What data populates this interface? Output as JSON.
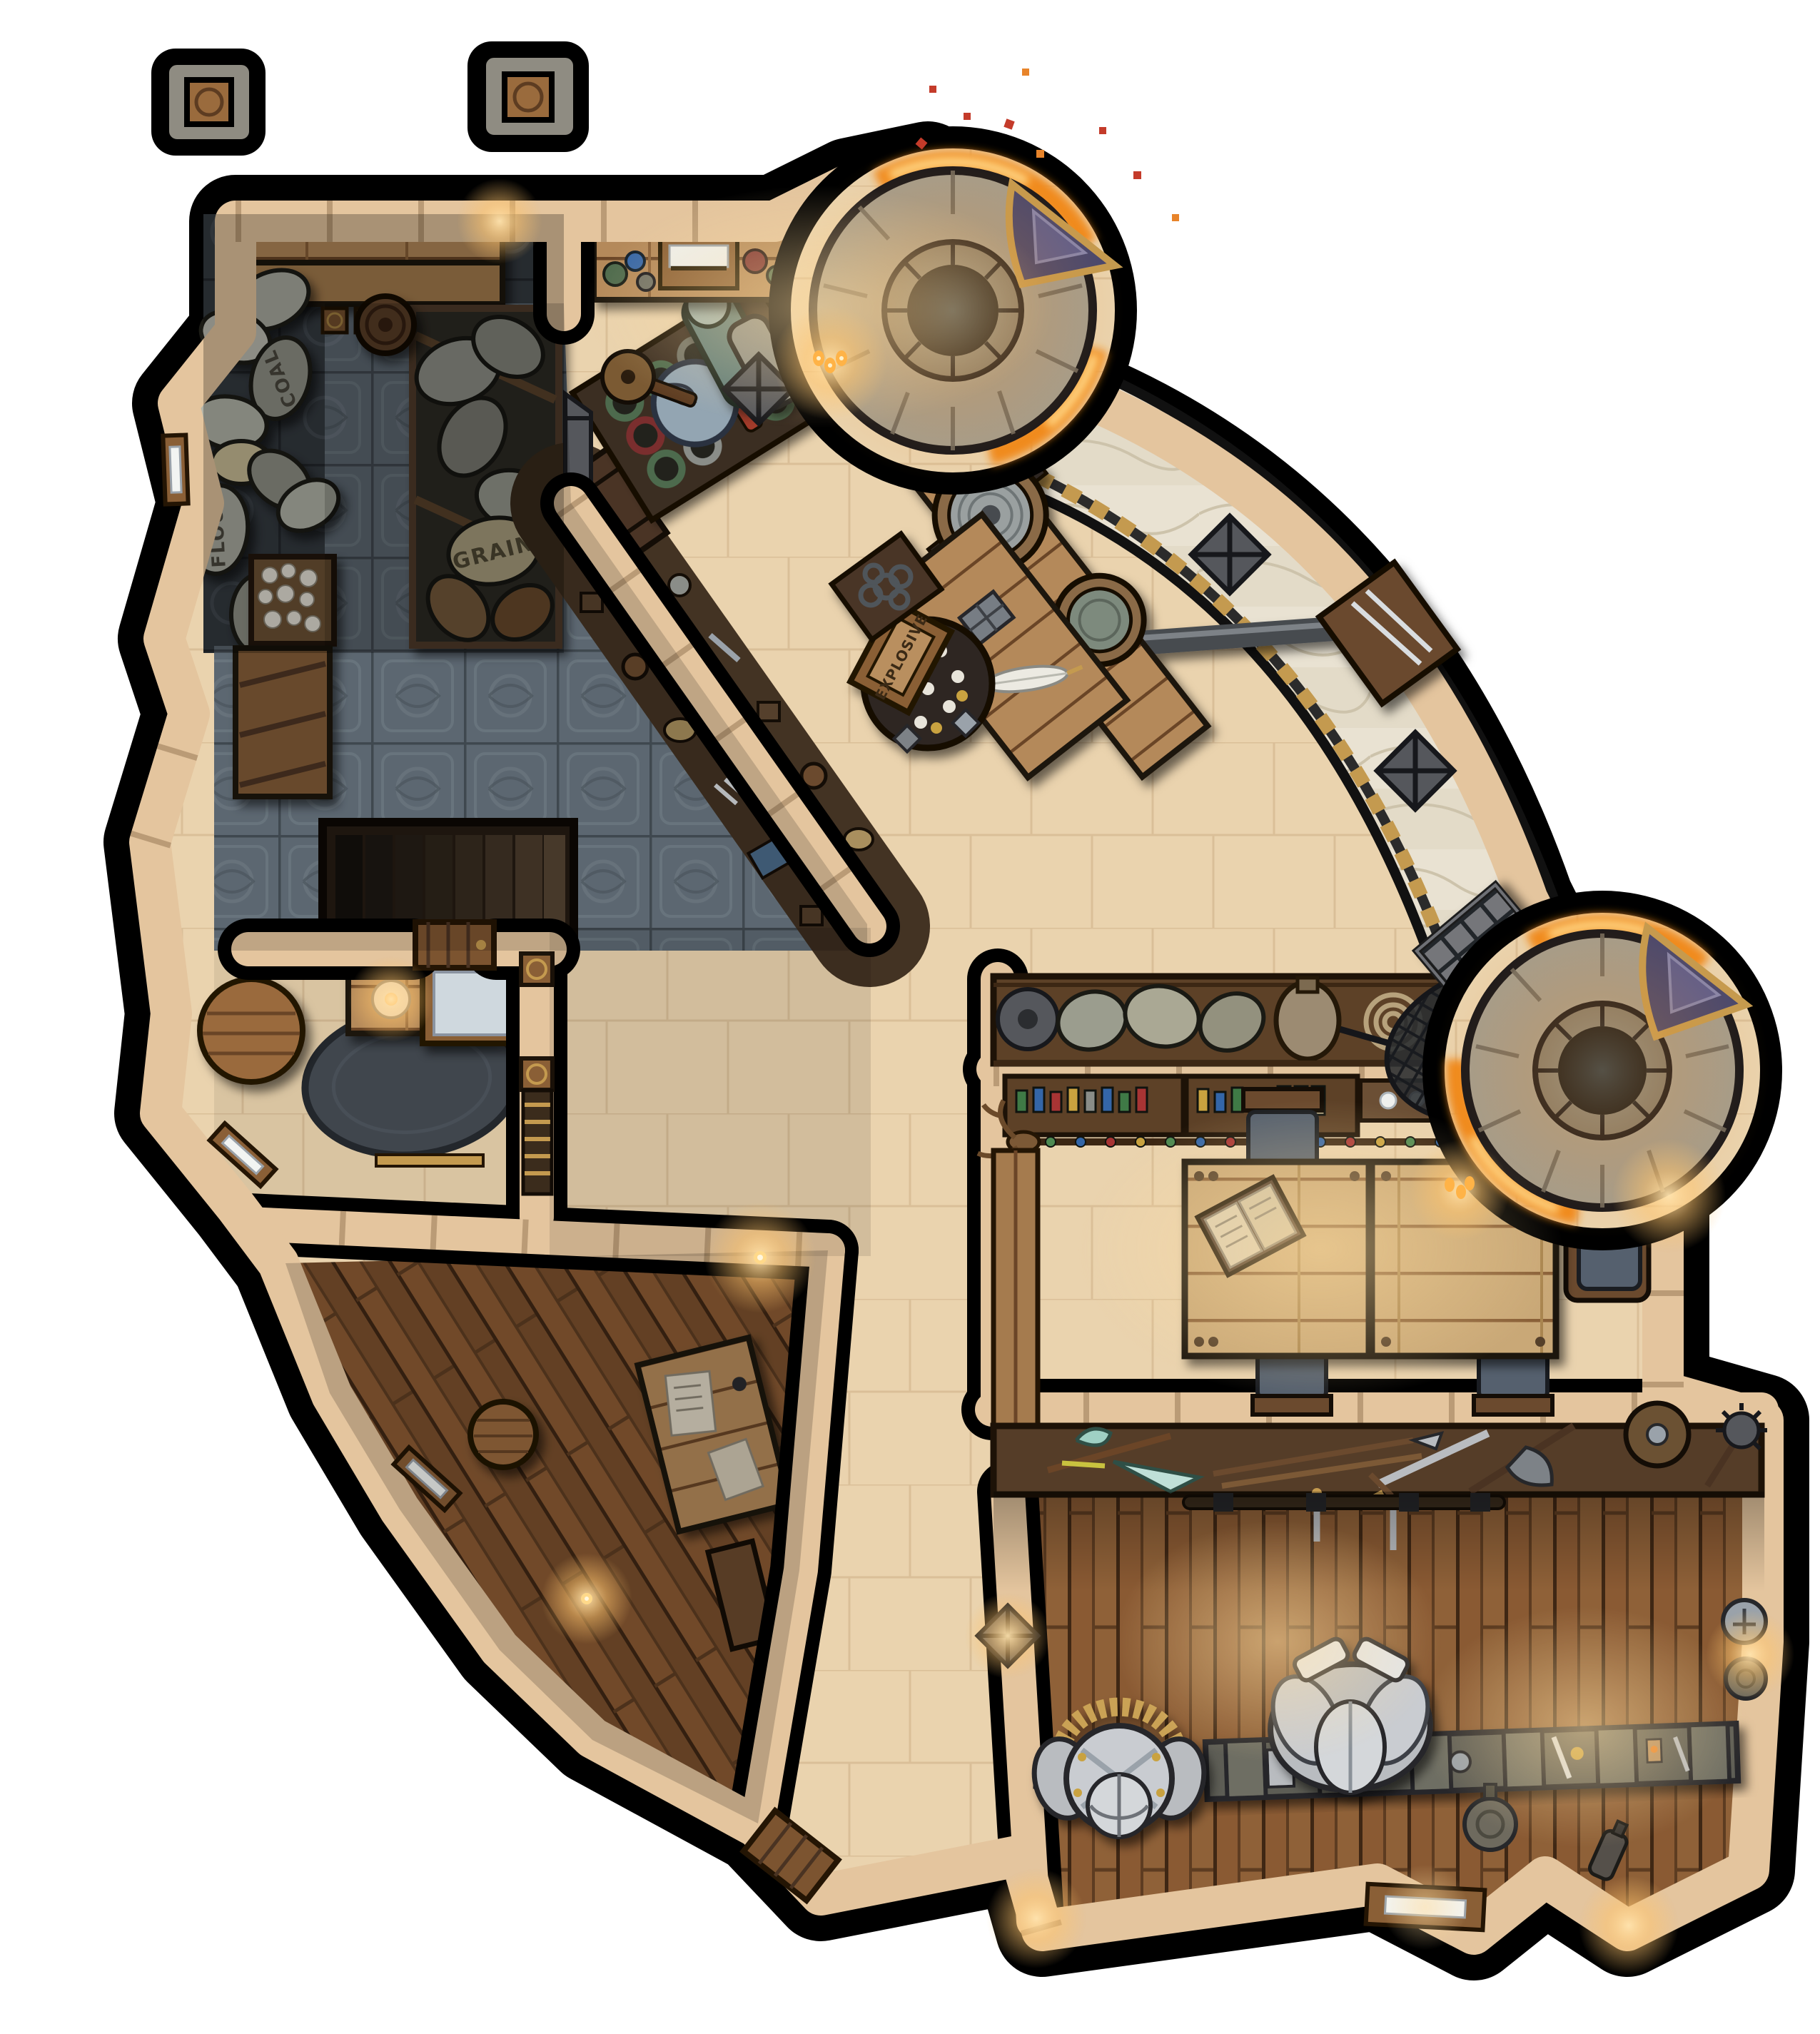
{
  "map": {
    "type": "fantasy-battle-map-topdown",
    "labels": {
      "flour": "FLOUR",
      "coal": "COAL",
      "grain": "GRAIN",
      "explosive": "EXPLOSIVE"
    },
    "colors": {
      "bg": "#ffffff",
      "shadow": "#000000",
      "wallStone": "#e4c59e",
      "wallStoneDark": "#bc9468",
      "hallFloor": "#ead3ae",
      "hallLine": "#d6ba92",
      "tileFloor": "#6e7b87",
      "tileLine": "#4c565f",
      "tileDark": "#343a40",
      "woodFloor": "#8a5a33",
      "woodDark": "#3f2714",
      "woodPlank": "#b4895a",
      "woodShelfDark": "#5d4127",
      "tableWood": "#c9a877",
      "marble": "#e9e2d2",
      "fire": "#f08a1d",
      "fireBright": "#ffd98a",
      "ember": "#c43b2a",
      "towerStone": "#a29c8e",
      "towerStoneDark": "#7e786b",
      "towerHole": "#0b0b0d",
      "bannerBlue": "#46466e",
      "bannerGold": "#c49a4f",
      "rug": "#40464d",
      "bedSheet": "#cfd8de",
      "sackGrey": "#a9aba0",
      "sackDark": "#8f9186",
      "sackTan": "#c9bd96",
      "armor": "#c9ccd1",
      "metal": "#9aa2aa",
      "glow": "#ffc56e",
      "bottleGreen": "#3f7a46",
      "bottleBlue": "#3466a8",
      "bottleRed": "#a83434",
      "bottleGold": "#c9a23f",
      "cushion": "#55606e"
    },
    "features": [
      "outer-stone-pillar",
      "storage-room",
      "grain-bay",
      "celtic-tiled-room",
      "staircase-down",
      "bedroom",
      "study-room",
      "great-hall",
      "merchant-stall",
      "goods-counter",
      "anvil",
      "crane-winch",
      "explosive-crate",
      "coin-table",
      "writing-desk",
      "forge-tower",
      "fire-ring",
      "tower-banner",
      "marble-walkway",
      "fishing-net",
      "metal-grate",
      "supply-shelf",
      "potion-shelf",
      "dining-room",
      "dining-table",
      "chair",
      "armchair",
      "open-book",
      "deer-trophy",
      "weapon-rack",
      "armory",
      "armor-stand",
      "tool-rack",
      "window",
      "door",
      "wall-lamp",
      "stone-crate",
      "coal-bin",
      "rug",
      "bed",
      "candle"
    ]
  }
}
